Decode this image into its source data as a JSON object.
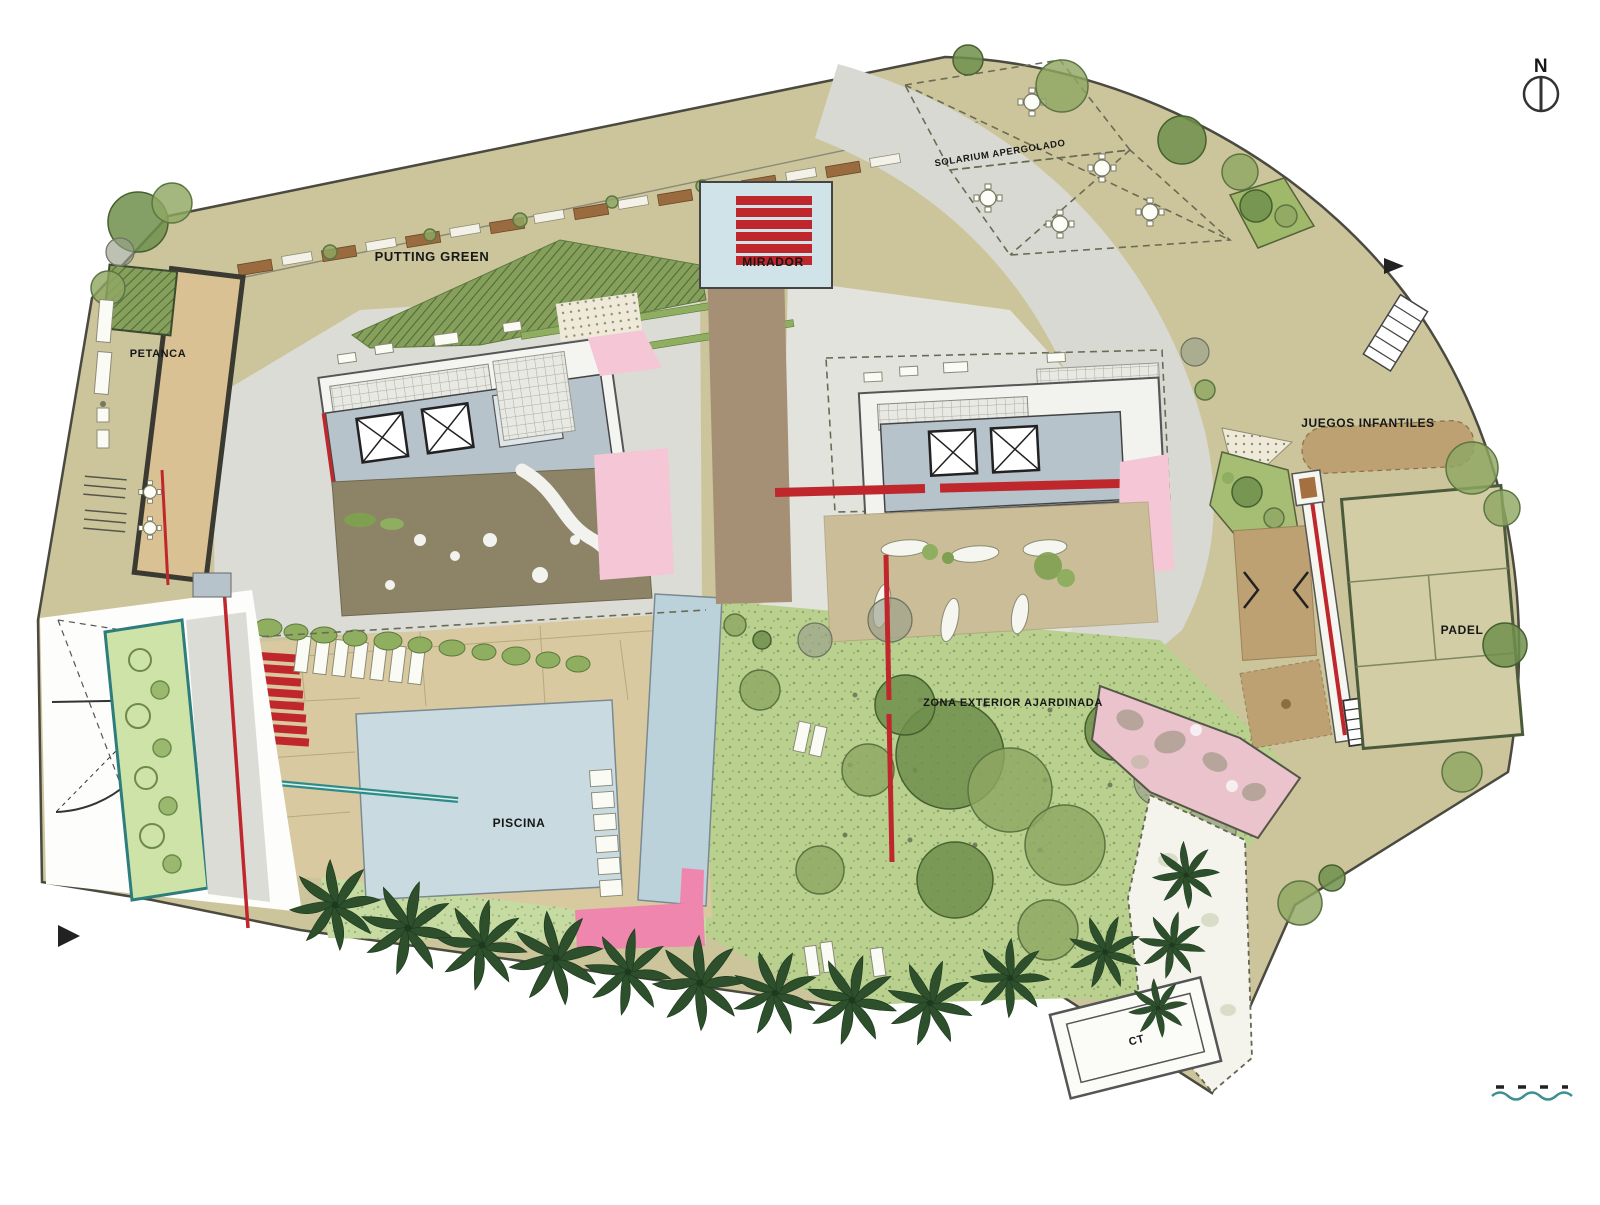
{
  "title": "Residential complex landscape site plan",
  "labels": {
    "putting_green": "PUTTING GREEN",
    "mirador": "MIRADOR",
    "petanca": "PETANCA",
    "solarium": "SOLARIUM APERGOLADO",
    "juegos_infantiles": "JUEGOS INFANTILES",
    "padel": "PADEL",
    "zona_exterior": "ZONA EXTERIOR AJARDINADA",
    "piscina": "PISCINA",
    "ct": "CT",
    "north": "N"
  },
  "colors": {
    "ground_khaki": "#ccc59c",
    "plaza_gray": "#dcdcd7",
    "pool_blue": "#c9dbe1",
    "lap_pool_blue": "#bcd2da",
    "lawn_green": "#c6dba2",
    "garden_green": "#b9d08f",
    "putting_green": "#7e9955",
    "accent_red": "#c0272d",
    "accent_pink": "#f5c6d6",
    "path_pink": "#eac3cc",
    "bright_pink": "#ee86ad",
    "roof_slab": "#b7c3cb",
    "terrace_olive": "#8d8468",
    "terrace_tan": "#cabd97",
    "palm_green": "#2d4f2c",
    "teal": "#2e8b8b",
    "mirador_path": "#a59076"
  }
}
